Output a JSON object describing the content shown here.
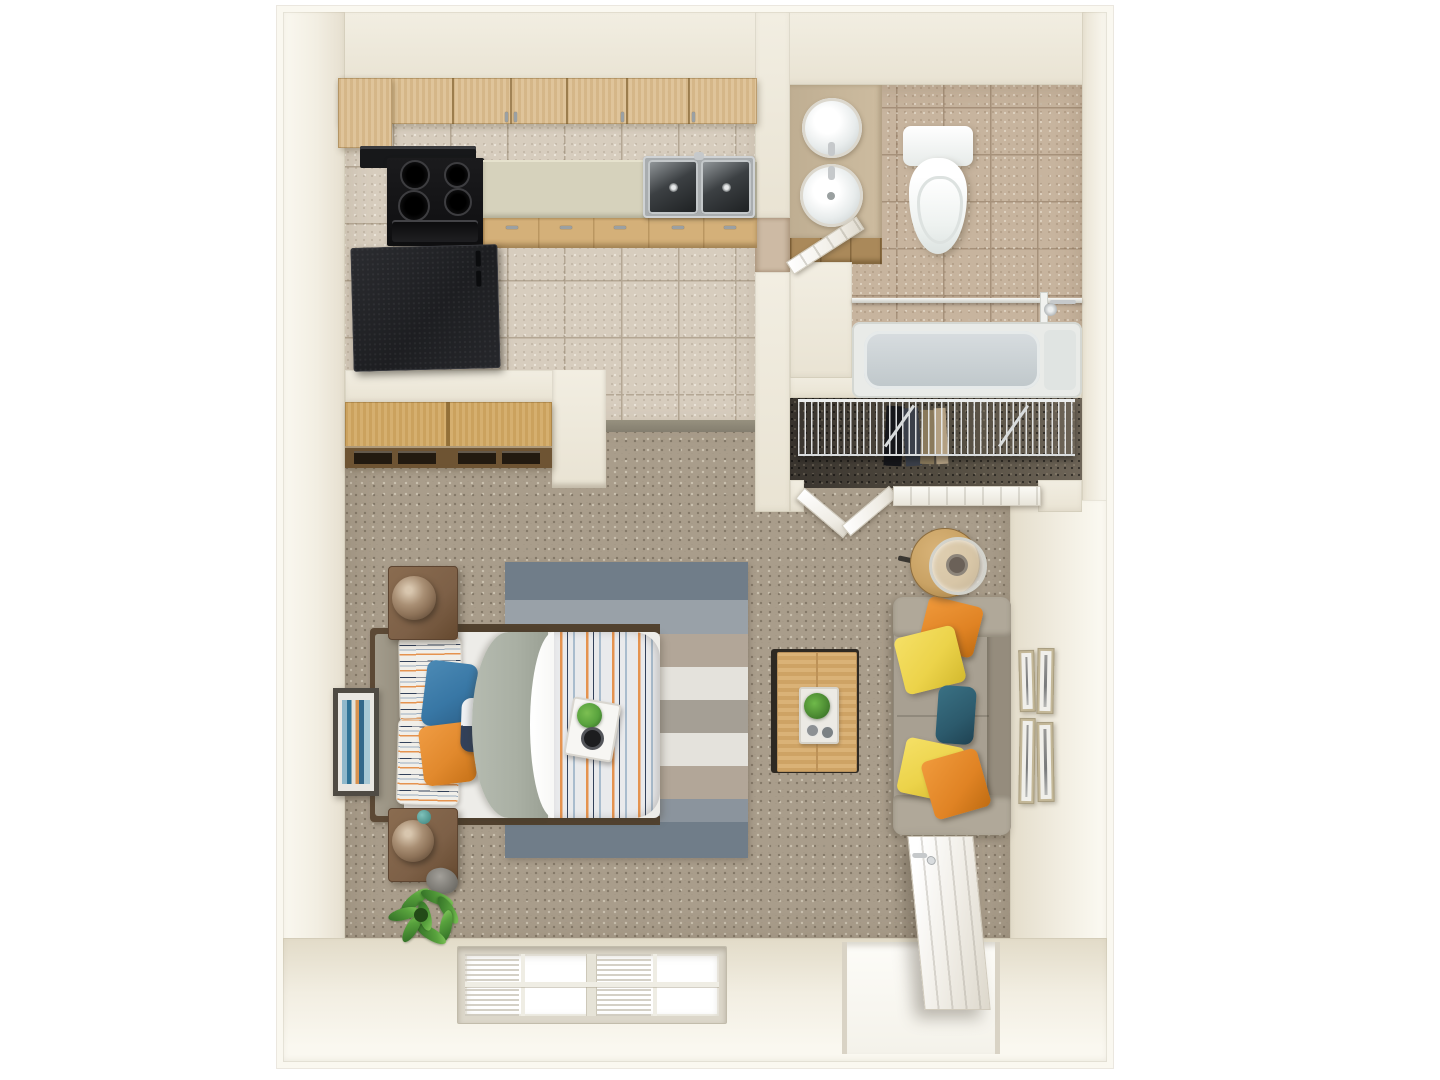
{
  "canvas": {
    "width": 1440,
    "height": 1080
  },
  "scene": {
    "type": "3d-floor-plan-top-down-render",
    "unit": "studio-apartment",
    "rooms": [
      {
        "name": "kitchen",
        "position": "top-left",
        "floor": "beige-tile",
        "items": [
          "upper-cabinets",
          "range-hood",
          "black-stove-4-burners",
          "sage-counter",
          "stainless-double-sink",
          "base-cabinets",
          "black-refrigerator"
        ]
      },
      {
        "name": "bathroom",
        "position": "top-right",
        "floor": "tan-tile",
        "items": [
          "vanity-with-two-round-sinks",
          "vanity-cabinets",
          "toilet",
          "bathtub",
          "shower-rod",
          "shower-glass-panel",
          "shower-fixture",
          "white-door-open"
        ]
      },
      {
        "name": "closet",
        "position": "right-middle",
        "floor": "dark-carpet",
        "items": [
          "wire-shelf",
          "hanging-clothes",
          "shelf-braces",
          "bifold-doors-open",
          "bifold-door-closed-panel"
        ]
      },
      {
        "name": "dressing-alcove",
        "position": "left-middle",
        "floor": "carpet",
        "items": [
          "wood-wardrobe-with-drawers"
        ]
      },
      {
        "name": "living-bedroom",
        "position": "bottom",
        "floor": "beige-carpet",
        "items": [
          "bed-with-striped-duvet",
          "headboard",
          "striped-pillows",
          "blue-pillow",
          "orange-pillow",
          "bolster-pillow",
          "grey-folded-blanket",
          "breakfast-tray-with-plant",
          "striped-area-rug",
          "nightstand-upper",
          "nightstand-lower",
          "bronze-table-lamps",
          "teal-decor-ball",
          "abstract-wall-art",
          "potted-plant",
          "decorative-stone",
          "taupe-sofa",
          "orange-throw-pillows",
          "yellow-throw-pillows",
          "teal-throw-pillow",
          "round-side-table-with-lamp",
          "oak-coffee-table",
          "white-serving-tray",
          "gallery-wall-four-frames",
          "double-window-with-blinds",
          "entry-door-open"
        ]
      }
    ]
  },
  "palette": {
    "bg": "#ffffff",
    "wallcut": "#faf8f0",
    "wall": "#f2eee2",
    "walldeep": "#e9e3d3",
    "tile": "#d7cdbe",
    "tilegrout": "#b4a794",
    "bathtile": "#c7b49e",
    "bathgrout": "#a6917a",
    "carpet": "#a99d8b",
    "wood": "#ddc092",
    "woodmid": "#d4b079",
    "wooddark": "#6e5433",
    "counter": "#d6d2bc",
    "appliance": "#141416",
    "fridge": "#222326",
    "stainless": "#a9adaf",
    "toiletwhite": "#f4f6f5",
    "tubinner": "#c9d0d3",
    "rugdark": "#707d89",
    "rugmid": "#99a1a8",
    "rugtan": "#b2a698",
    "ruglight": "#e4e2dc",
    "blanket": "#a9afa3",
    "duvetbase": "#e9eaec",
    "stripeorange": "#e5934f",
    "stripeblue": "#a9bccd",
    "stripenavy": "#32415a",
    "pillowblue": "#3877a5",
    "pilloworange": "#e1892d",
    "pillowyellow": "#ecd34a",
    "pillowteal": "#2c5a6c",
    "sofabody": "#a8a092",
    "sofaarm": "#b0a899",
    "sofaback": "#958c7d",
    "nightstand": "#7d6047",
    "lampbronze": "#8d7258",
    "tablewood": "#c9a264",
    "coffeewood": "#d6aa6b",
    "framekhaki": "#c3b797",
    "plantgreen": "#58a23d",
    "plantdark": "#2f6b24",
    "artteal": "#2f7396",
    "artorange": "#d8924f"
  }
}
